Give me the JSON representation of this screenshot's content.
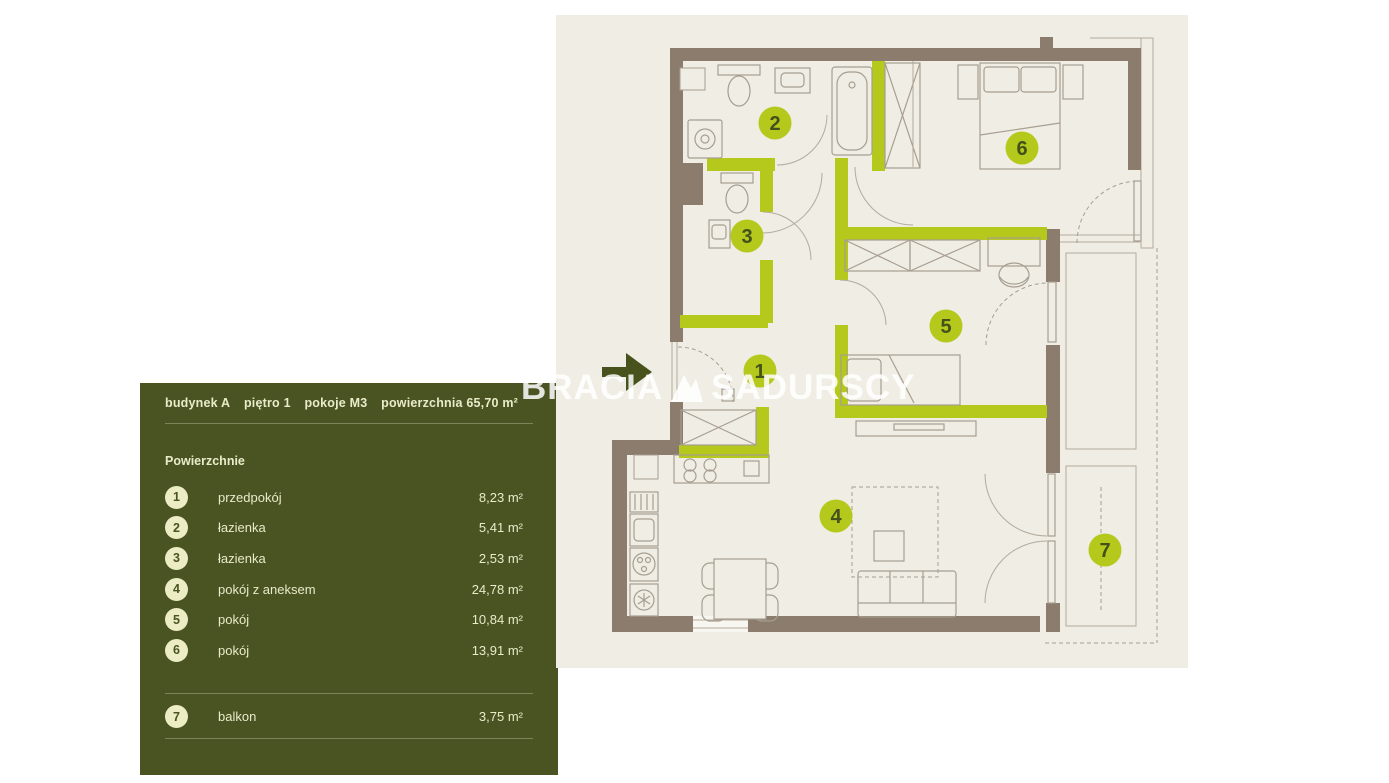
{
  "watermark": {
    "left": "BRACIA",
    "right": "SADURSCY"
  },
  "panel": {
    "header": [
      "budynek A",
      "piętro 1",
      "pokoje M3",
      "powierzchnia 65,70 m²"
    ],
    "section_title": "Powierzchnie",
    "rooms": [
      {
        "num": "1",
        "name": "przedpokój",
        "area": "8,23 m²"
      },
      {
        "num": "2",
        "name": "łazienka",
        "area": "5,41 m²"
      },
      {
        "num": "3",
        "name": "łazienka",
        "area": "2,53 m²"
      },
      {
        "num": "4",
        "name": "pokój z aneksem",
        "area": "24,78 m²"
      },
      {
        "num": "5",
        "name": "pokój",
        "area": "10,84 m²"
      },
      {
        "num": "6",
        "name": "pokój",
        "area": "13,91 m²"
      }
    ],
    "balcony_row": {
      "num": "7",
      "name": "balkon",
      "area": "3,75 m²"
    }
  },
  "plan": {
    "markers": [
      {
        "num": "1"
      },
      {
        "num": "2"
      },
      {
        "num": "3"
      },
      {
        "num": "4"
      },
      {
        "num": "5"
      },
      {
        "num": "6"
      },
      {
        "num": "7"
      }
    ]
  },
  "colors": {
    "accent_lime": "#b5c91c",
    "panel_green": "#4a5322",
    "wall_brown": "#8b7c6d",
    "plan_background": "#f0ede4",
    "badge_cream": "#ecedc4"
  }
}
